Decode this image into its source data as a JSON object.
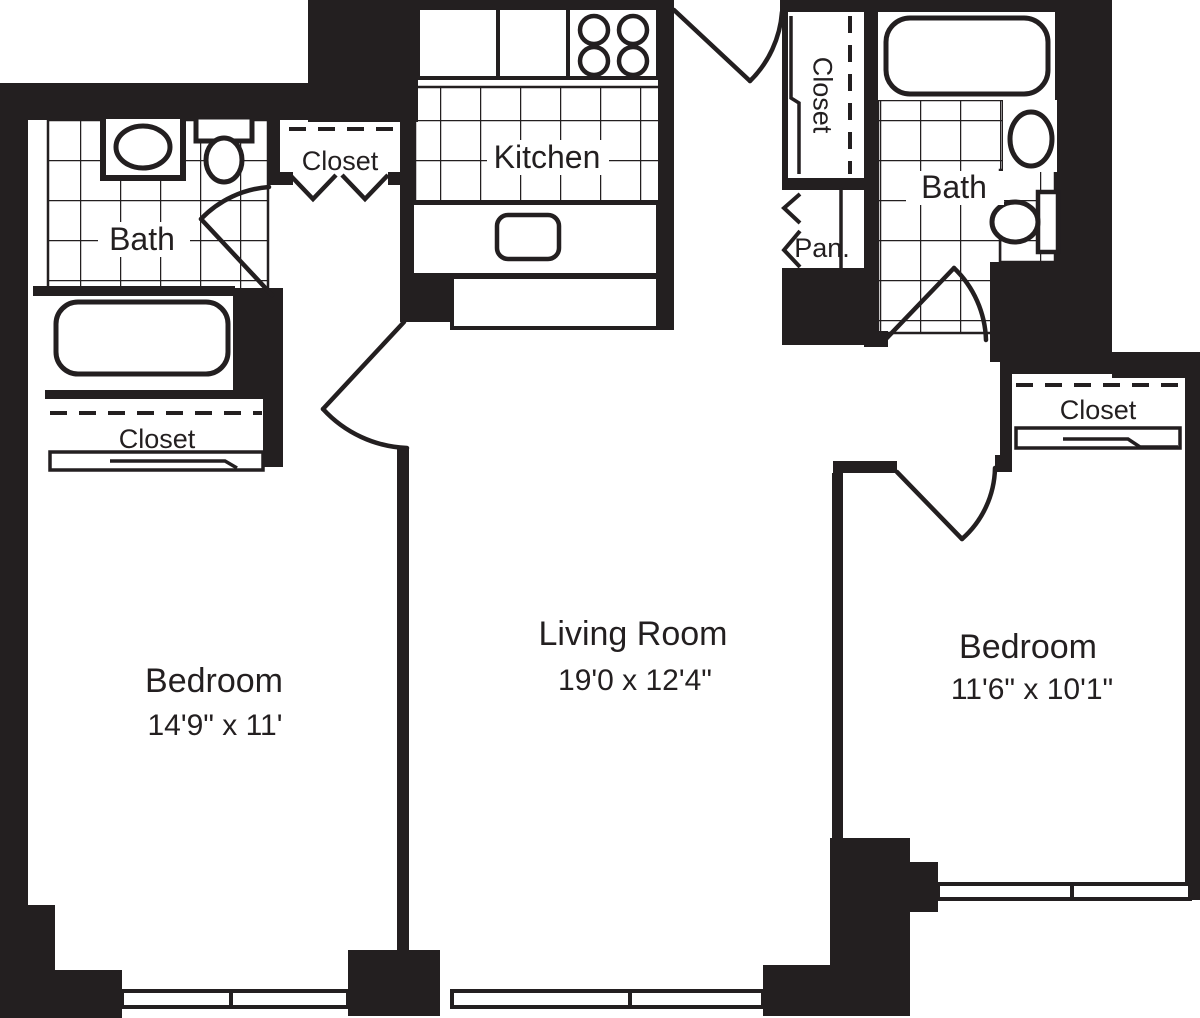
{
  "plan": {
    "type": "apartment-floor-plan",
    "colors": {
      "wall": "#231f20",
      "background": "#ffffff",
      "line": "#231f20"
    },
    "rooms": {
      "bedroom_left": {
        "name": "Bedroom",
        "dims": "14'9\" x 11'"
      },
      "living_room": {
        "name": "Living Room",
        "dims": "19'0 x 12'4\""
      },
      "bedroom_right": {
        "name": "Bedroom",
        "dims": "11'6\" x 10'1\""
      },
      "kitchen": {
        "label": "Kitchen"
      },
      "bath_left": {
        "label": "Bath"
      },
      "bath_right": {
        "label": "Bath"
      },
      "pantry": {
        "label": "Pan."
      }
    },
    "closets": {
      "hall_closet": {
        "label": "Closet"
      },
      "entry_closet": {
        "label": "Closet"
      },
      "bedroom_left_closet": {
        "label": "Closet"
      },
      "bedroom_right_closet": {
        "label": "Closet"
      }
    },
    "fixtures": [
      "tub-left",
      "sink-left",
      "toilet-left",
      "tub-right",
      "sink-right",
      "toilet-right",
      "stove-4-burner",
      "kitchen-sink",
      "refrigerator",
      "counters"
    ]
  }
}
